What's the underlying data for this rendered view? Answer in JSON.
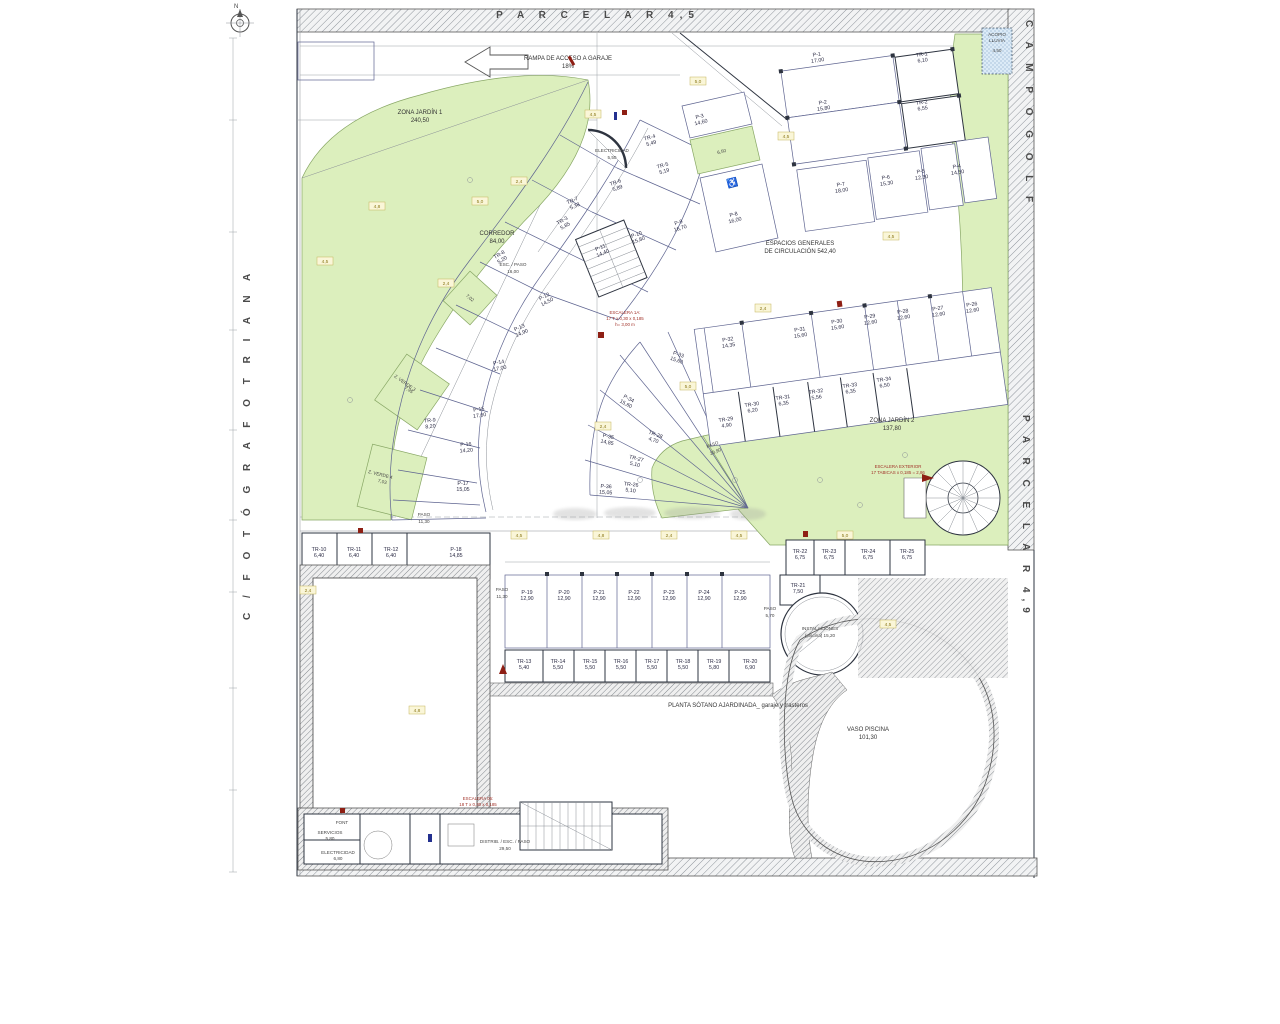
{
  "streets": {
    "top": "P A R C E L A   R 4,5",
    "right_top": "C A M P O   G O L F",
    "right_bottom": "P A R C E L A   R 4,9",
    "left": "C /   F O T Ó G R A F O       T R I A N A",
    "north": "N"
  },
  "notes": {
    "ramp": "RAMPA DE ACCESO A GARAJE",
    "ramp_slope": "18%",
    "planta": "PLANTA SÓTANO AJARDINADA_ garaje y trasteros",
    "acopio1": "ACOPIO",
    "acopio2": "LLUVIA",
    "acopio3": "4,50",
    "escalera1a_1": "ESCALERA 1A:",
    "escalera1a_2": "17 T x 0,30 x 0,185",
    "escalera1a_3": "h= 3,00 m",
    "escalera_ext1": "ESCALERA EXTERIOR",
    "escalera_ext2": "17 TABICAS x 0,185 = 2,86",
    "escalera05_1": "ESCALERA 05:",
    "escalera05_2": "18 T x 0,30 x 0,185",
    "font": "FONT"
  },
  "rooms": {
    "jardin1": {
      "n": "ZONA JARDÍN 1",
      "a": "240,50"
    },
    "jardin2": {
      "n": "ZONA JARDÍN 2",
      "a": "137,80"
    },
    "zverde3": {
      "n": "Z. VERDE 3",
      "a": "7,95"
    },
    "zverde4": {
      "n": "Z. VERDE 4",
      "a": "7,03"
    },
    "zverde_mid": "7,02",
    "disabled_annex": "6,50",
    "corredor": {
      "n": "CORREDOR",
      "a": "84,00"
    },
    "esc_paso": {
      "n": "ESC. / PASO",
      "a": "16,00"
    },
    "electricidad_top": {
      "n": "ELECTRICIDAD",
      "a": "5,50"
    },
    "espacios1": "ESPACIOS GENERALES",
    "espacios2": "DE CIRCULACIÓN   542,40",
    "paso_left": {
      "n": "PASO",
      "a": "11,30"
    },
    "paso_left2": {
      "n": "PASO",
      "a": "11,30"
    },
    "paso_fan": {
      "n": "PASO",
      "a": "20,90"
    },
    "paso_right": {
      "n": "PASO",
      "a": "5,70"
    },
    "instalaciones1": "INSTALACIONES",
    "instalaciones2": "(piscina)   15,20",
    "vaso": {
      "n": "VASO PISCINA",
      "a": "101,30"
    },
    "servicios": {
      "n": "SERVICIOS",
      "a": "5,80"
    },
    "electricidad_b": {
      "n": "ELECTRICIDAD",
      "a": "6,80"
    },
    "distrib": {
      "n": "DISTRIB. / ESC. / PASO",
      "a": "29,50"
    }
  },
  "parking": {
    "p1": {
      "id": "P-1",
      "area": "17,00"
    },
    "p2": {
      "id": "P-2",
      "area": "15,80"
    },
    "p3": {
      "id": "P-3",
      "area": "14,60"
    },
    "p4": {
      "id": "P-4",
      "area": "14,50"
    },
    "p5": {
      "id": "P-5",
      "area": "12,30"
    },
    "p6": {
      "id": "P-6",
      "area": "15,30"
    },
    "p7": {
      "id": "P-7",
      "area": "18,00"
    },
    "p8": {
      "id": "P-8",
      "area": "16,00"
    },
    "p9": {
      "id": "P-9",
      "area": "16,70"
    },
    "p10": {
      "id": "P-10",
      "area": "15,80"
    },
    "p11": {
      "id": "P-11",
      "area": "14,40"
    },
    "p12": {
      "id": "P-12",
      "area": "14,50"
    },
    "p13": {
      "id": "P-13",
      "area": "14,90"
    },
    "p14": {
      "id": "P-14",
      "area": "17,00"
    },
    "p15": {
      "id": "P-15",
      "area": "17,60"
    },
    "p16": {
      "id": "P-16",
      "area": "14,20"
    },
    "p17": {
      "id": "P-17",
      "area": "15,05"
    },
    "p18": {
      "id": "P-18",
      "area": "14,85"
    },
    "p19": {
      "id": "P-19",
      "area": "12,90"
    },
    "p20": {
      "id": "P-20",
      "area": "12,90"
    },
    "p21": {
      "id": "P-21",
      "area": "12,90"
    },
    "p22": {
      "id": "P-22",
      "area": "12,90"
    },
    "p23": {
      "id": "P-23",
      "area": "12,90"
    },
    "p24": {
      "id": "P-24",
      "area": "12,90"
    },
    "p25": {
      "id": "P-25",
      "area": "12,90"
    },
    "p26": {
      "id": "P-26",
      "area": "12,60"
    },
    "p27": {
      "id": "P-27",
      "area": "12,60"
    },
    "p28": {
      "id": "P-28",
      "area": "12,60"
    },
    "p29": {
      "id": "P-29",
      "area": "12,60"
    },
    "p30": {
      "id": "P-30",
      "area": "15,60"
    },
    "p31": {
      "id": "P-31",
      "area": "15,60"
    },
    "p32": {
      "id": "P-32",
      "area": "14,35"
    },
    "p33": {
      "id": "P-33",
      "area": "15,60"
    },
    "p34": {
      "id": "P-34",
      "area": "15,60"
    },
    "p35": {
      "id": "P-35",
      "area": "14,85"
    },
    "p36": {
      "id": "P-36",
      "area": "15,05"
    }
  },
  "storage": {
    "tr1": {
      "id": "TR-1",
      "area": "6,10"
    },
    "tr2": {
      "id": "TR-2",
      "area": "6,55"
    },
    "tr3": {
      "id": "TR-3",
      "area": "5,85"
    },
    "tr4": {
      "id": "TR-4",
      "area": "5,49"
    },
    "tr5": {
      "id": "TR-5",
      "area": "5,19"
    },
    "tr6": {
      "id": "TR-6",
      "area": "5,89"
    },
    "tr7": {
      "id": "TR-7",
      "area": "5,38"
    },
    "tr8": {
      "id": "TR-8",
      "area": "5,20"
    },
    "tr9": {
      "id": "TR-9",
      "area": "8,20"
    },
    "tr10": {
      "id": "TR-10",
      "area": "6,40"
    },
    "tr11": {
      "id": "TR-11",
      "area": "6,40"
    },
    "tr12": {
      "id": "TR-12",
      "area": "6,40"
    },
    "tr13": {
      "id": "TR-13",
      "area": "5,40"
    },
    "tr14": {
      "id": "TR-14",
      "area": "5,50"
    },
    "tr15": {
      "id": "TR-15",
      "area": "5,50"
    },
    "tr16": {
      "id": "TR-16",
      "area": "5,50"
    },
    "tr17": {
      "id": "TR-17",
      "area": "5,50"
    },
    "tr18": {
      "id": "TR-18",
      "area": "5,50"
    },
    "tr19": {
      "id": "TR-19",
      "area": "5,80"
    },
    "tr20": {
      "id": "TR-20",
      "area": "6,90"
    },
    "tr21": {
      "id": "TR-21",
      "area": "7,50"
    },
    "tr22": {
      "id": "TR-22",
      "area": "6,75"
    },
    "tr23": {
      "id": "TR-23",
      "area": "6,75"
    },
    "tr24": {
      "id": "TR-24",
      "area": "6,75"
    },
    "tr25": {
      "id": "TR-25",
      "area": "6,75"
    },
    "tr26": {
      "id": "TR-26",
      "area": "5,10"
    },
    "tr27": {
      "id": "TR-27",
      "area": "5,10"
    },
    "tr28": {
      "id": "TR-28",
      "area": "4,70"
    },
    "tr29": {
      "id": "TR-29",
      "area": "4,90"
    },
    "tr30": {
      "id": "TR-30",
      "area": "6,20"
    },
    "tr31": {
      "id": "TR-31",
      "area": "6,35"
    },
    "tr32": {
      "id": "TR-32",
      "area": "5,56"
    },
    "tr33": {
      "id": "TR-33",
      "area": "6,35"
    },
    "tr34": {
      "id": "TR-34",
      "area": "6,50"
    }
  },
  "tags": [
    "4,5",
    "2,4",
    "5,0",
    "4,8",
    "4,5",
    "2,4",
    "5,0",
    "4,5",
    "2,4",
    "4,5",
    "5,0",
    "2,4",
    "4,5",
    "4,8",
    "2,4",
    "4,5",
    "5,0",
    "2,4",
    "4,5",
    "4,8"
  ],
  "colors": {
    "garden": "#dcefbd",
    "hatch": "#9aa0a8",
    "parking_line": "#5e6490",
    "wall": "#2e3440",
    "water": "#cfe3f5"
  }
}
